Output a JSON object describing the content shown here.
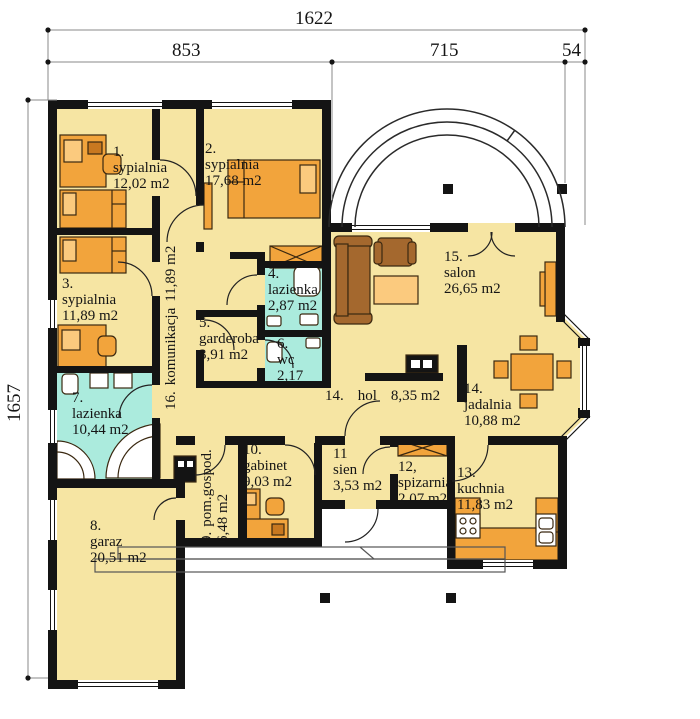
{
  "dimensions": {
    "top_total": "1622",
    "top_left": "853",
    "top_right": "715",
    "top_edge": "54",
    "side_height": "1657"
  },
  "rooms": [
    {
      "number": "1.",
      "name": "sypialnia",
      "area": "12,02 m2"
    },
    {
      "number": "2.",
      "name": "sypialnia",
      "area": "17,68 m2"
    },
    {
      "number": "3.",
      "name": "sypialnia",
      "area": "11,89 m2"
    },
    {
      "number": "4.",
      "name": "lazienka",
      "area": "2,87 m2"
    },
    {
      "number": "5.",
      "name": "garderoba",
      "area": "3,91 m2"
    },
    {
      "number": "6.",
      "name": "wc",
      "area": "2,17"
    },
    {
      "number": "7.",
      "name": "lazienka",
      "area": "10,44 m2"
    },
    {
      "number": "8.",
      "name": "garaz",
      "area": "20,51 m2"
    },
    {
      "number": "9.",
      "name": "pom.gospod.",
      "area": "6,48 m2"
    },
    {
      "number": "10.",
      "name": "gabinet",
      "area": "9,03 m2"
    },
    {
      "number": "11",
      "name": "sien",
      "area": "3,53 m2"
    },
    {
      "number": "12,",
      "name": "spizarnia",
      "area": "2,07 m2"
    },
    {
      "number": "13.",
      "name": "kuchnia",
      "area": "11,83 m2"
    },
    {
      "number": "14.",
      "name": "hol",
      "area": "8,35 m2"
    },
    {
      "number": "14.",
      "name": "jadalnia",
      "area": "10,88 m2"
    },
    {
      "number": "15.",
      "name": "salon",
      "area": "26,65 m2"
    },
    {
      "number": "16.",
      "name": "komunikacja",
      "area": "11,89 m2"
    }
  ],
  "colors": {
    "floor": "#F6E5A3",
    "bath_floor": "#ABEBDD",
    "furniture": "#F2A43C",
    "furniture_light": "#FBCA7E",
    "sofa_brown": "#A4682E",
    "wall": "#141414"
  }
}
